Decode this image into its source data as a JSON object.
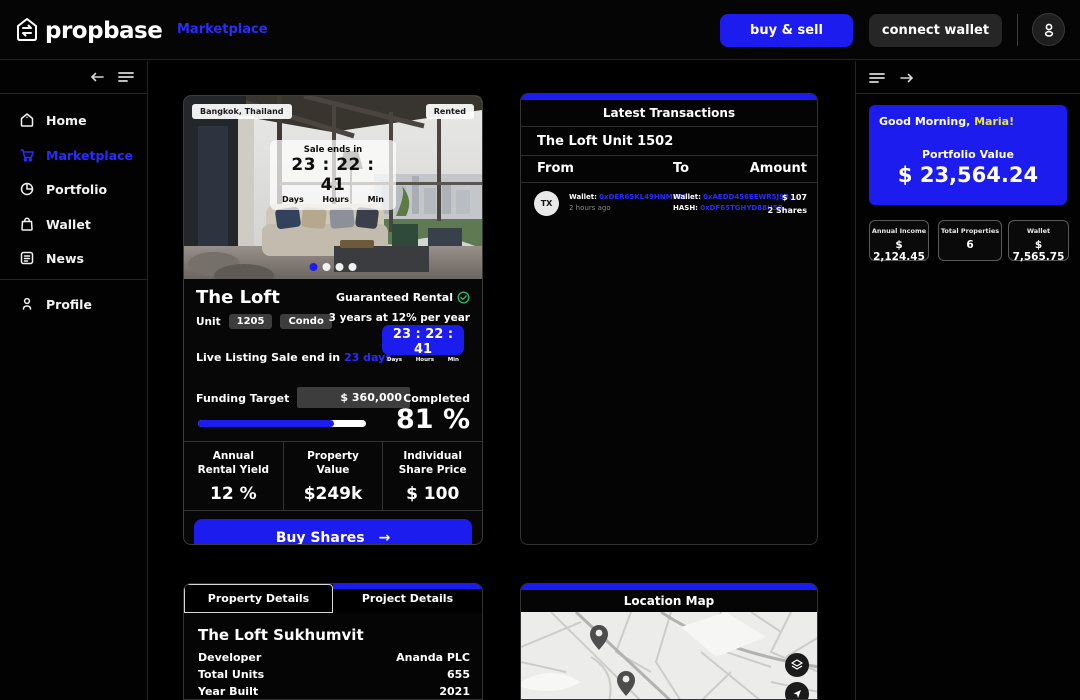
{
  "topbar": {
    "brand": "propbase",
    "marketplace_link": "Marketplace",
    "buy_sell_label": "buy & sell",
    "connect_wallet_label": "connect wallet"
  },
  "sidebar": {
    "items": [
      {
        "label": "Home"
      },
      {
        "label": "Marketplace"
      },
      {
        "label": "Portfolio"
      },
      {
        "label": "Wallet"
      },
      {
        "label": "News"
      }
    ],
    "profile_label": "Profile"
  },
  "property_card": {
    "location_badge": "Bangkok, Thailand",
    "status_badge": "Rented",
    "sale_ends_label": "Sale ends in",
    "sale_countdown": "23 : 22 : 41",
    "days_label": "Days",
    "hours_label": "Hours",
    "min_label": "Min",
    "title": "The Loft",
    "guaranteed_label": "Guaranteed Rental",
    "guarantee_detail": "3 years at 12% per year",
    "unit_label": "Unit",
    "unit_value": "1205",
    "type_badge": "Condo",
    "live_listing_label": "Live Listing Sale end in",
    "live_listing_days": "23 days",
    "countdown_chip": "23 : 22 : 41",
    "funding_target_label": "Funding Target",
    "funding_target_value": "$ 360,000",
    "completed_label": "Completed",
    "completed_value": "81 %",
    "progress_percent": 81,
    "stats": [
      {
        "label": "Annual\nRental Yield",
        "value": "12 %"
      },
      {
        "label": "Property\nValue",
        "value": "$249k"
      },
      {
        "label": "Individual\nShare Price",
        "value": "$ 100"
      }
    ],
    "buy_button": "Buy Shares",
    "buy_arrow": "→"
  },
  "transactions": {
    "title": "Latest Transactions",
    "subtitle": "The Loft Unit 1502",
    "col_from": "From",
    "col_to": "To",
    "col_amount": "Amount",
    "rows": [
      {
        "icon": "TX",
        "from_wallet_label": "Wallet:",
        "from_wallet": "0xDER65KL49HNM8Y5...",
        "time": "2 hours ago",
        "to_wallet_label": "Wallet:",
        "to_wallet": "0xAEDD456EEWR5J98...",
        "hash_label": "HASH:",
        "hash": "0xDF65TGHYD88H5R...",
        "amount": "$ 107",
        "shares": "2 Shares"
      }
    ]
  },
  "portfolio_panel": {
    "greeting": "Good Morning,",
    "name": "Maria!",
    "value_label": "Portfolio Value",
    "value": "$ 23,564.24",
    "stats": [
      {
        "label": "Annual Income",
        "value": "$ 2,124.45"
      },
      {
        "label": "Total Properties",
        "value": "6"
      },
      {
        "label": "Wallet",
        "value": "$ 7,565.75"
      }
    ]
  },
  "details_panel": {
    "tab_property": "Property Details",
    "tab_project": "Project Details",
    "title": "The Loft Sukhumvit",
    "rows": [
      {
        "label": "Developer",
        "value": "Ananda PLC"
      },
      {
        "label": "Total Units",
        "value": "655"
      },
      {
        "label": "Year Built",
        "value": "2021"
      }
    ]
  },
  "map_panel": {
    "title": "Location Map"
  },
  "colors": {
    "accent": "#1c1cef",
    "link_blue": "#2b2bff",
    "name_yellow": "#e8e845",
    "check_green": "#27b376"
  }
}
